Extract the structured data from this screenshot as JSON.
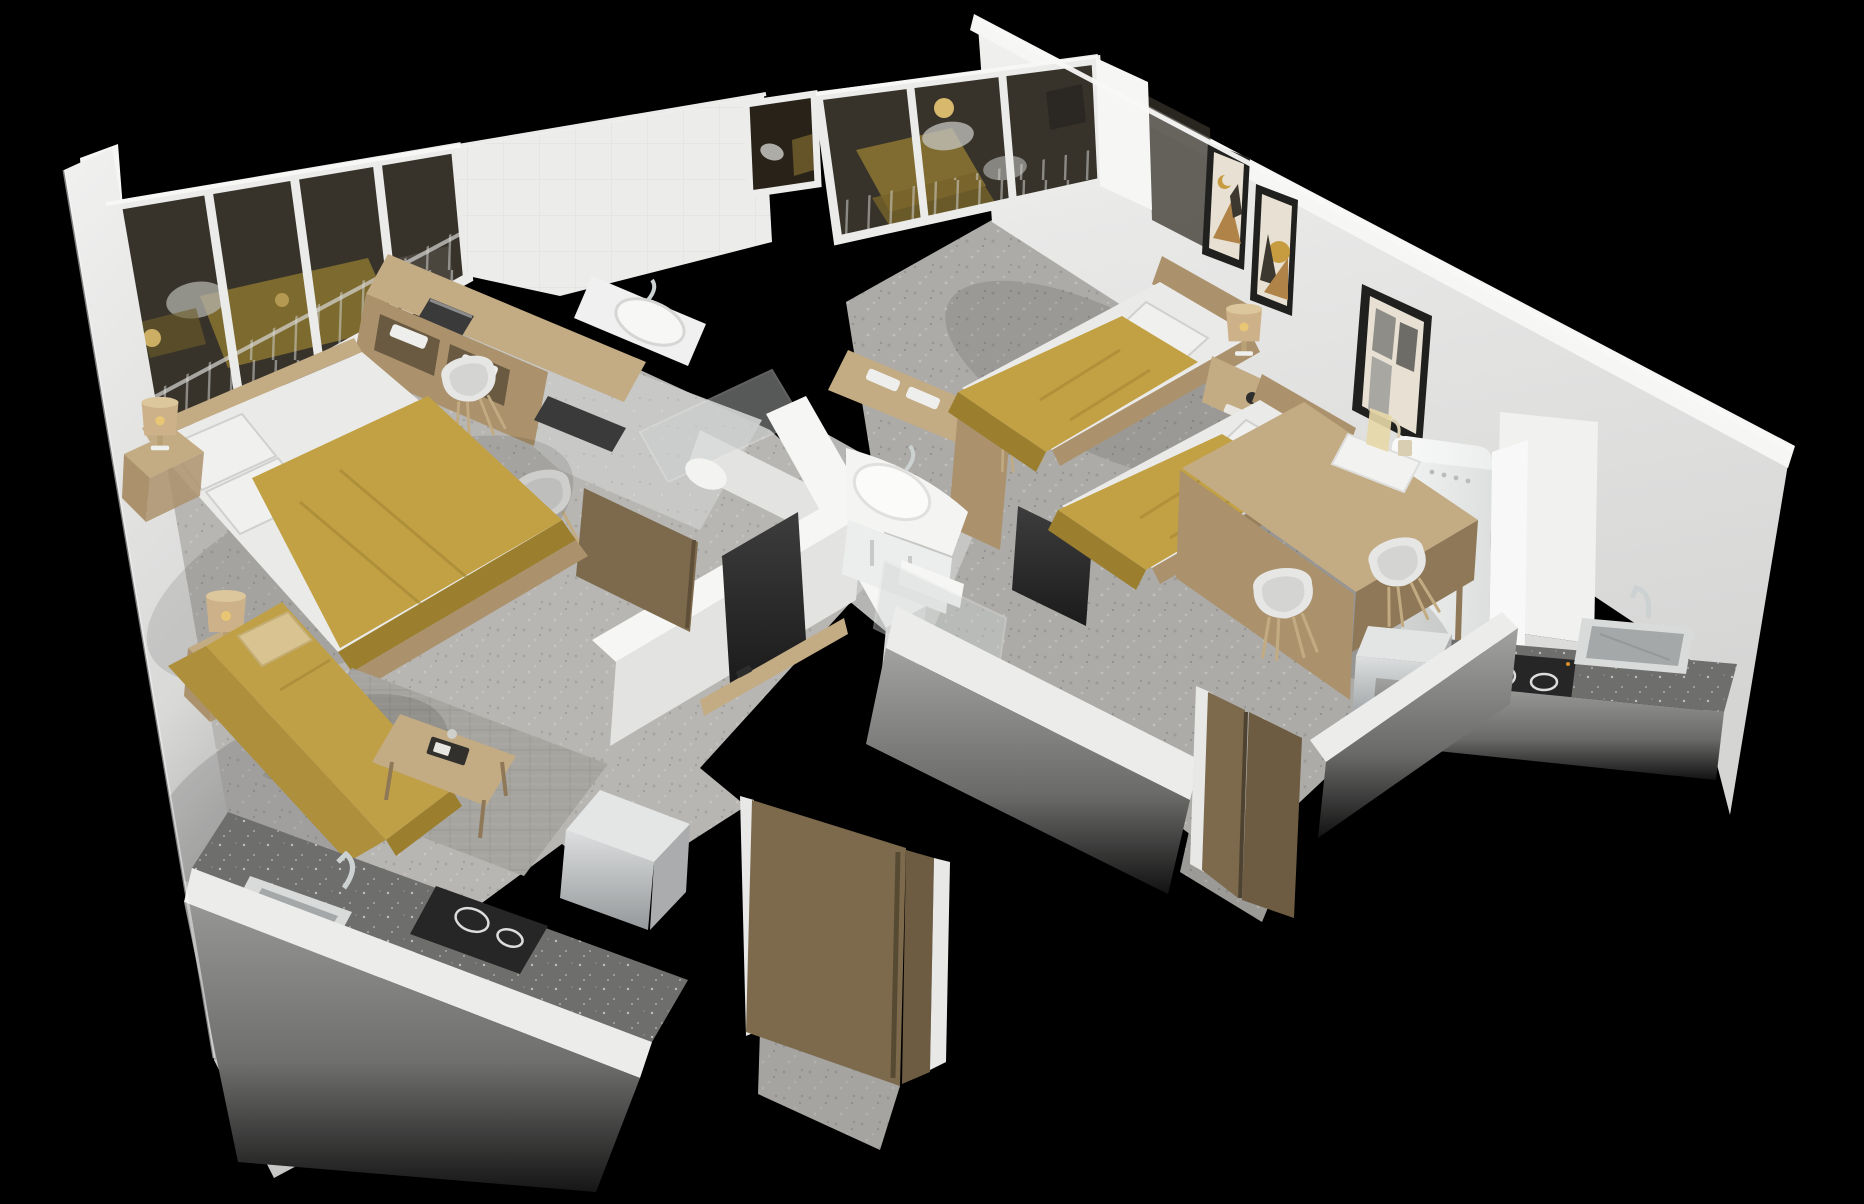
{
  "scene": {
    "type": "3d-apartment-floorplan-render",
    "view": "isometric-cutaway",
    "background": "#000000",
    "units": [
      {
        "id": "studio-left",
        "rooms": [
          "bedroom-living",
          "bathroom",
          "kitchenette",
          "entry-hall",
          "balcony"
        ],
        "furniture": [
          "double-bed",
          "nightstands-with-lamps",
          "yellow-sofa",
          "cream-throw-pillow",
          "coffee-table",
          "area-rug",
          "kitchen-counter",
          "steel-sink",
          "induction-cooktop",
          "mini-appliance-box",
          "wall-tv",
          "media-shelf",
          "desk-with-laptops",
          "towel-shelving",
          "vanity-sink",
          "shell-chairs",
          "entry-door",
          "bathroom-door",
          "glazed-balcony-wall",
          "balcony-railing"
        ]
      },
      {
        "id": "studio-right",
        "rooms": [
          "twin-bedroom",
          "bathroom",
          "kitchenette",
          "entry-hall",
          "balcony"
        ],
        "furniture": [
          "single-bed-1",
          "single-bed-2",
          "nightstand-with-lamp",
          "alarm-clock",
          "framed-wall-art-pair",
          "leaning-art-frame",
          "retro-fridge",
          "kitchen-counter",
          "steel-sink",
          "induction-cooktop",
          "mini-appliance-box",
          "dining-desk-table",
          "serving-tray-with-pitcher",
          "shell-chairs",
          "wall-tv",
          "curved-vanity-sink",
          "shower-glass-toilet",
          "desk-with-towels",
          "entry-door",
          "glazed-balcony-wall",
          "balcony-railing",
          "small-bathroom-window"
        ]
      }
    ]
  },
  "colors": {
    "background": "#000000",
    "wall_top": "#f6f6f5",
    "wall_face": "#ececeb",
    "wall_face_shade": "#d7d7d6",
    "wall_inner": "#e3e3e2",
    "wall_outer": "#9a9a99",
    "floor_light": "#b7b6b3",
    "floor_mid": "#adacaa",
    "floor_bath": "#cacac8",
    "rug": "#a7a5a0",
    "glass_dark": "#37332b",
    "mullion": "#ebebe9",
    "counter_dark": "#6e6e6c",
    "cooktop_black": "#262626",
    "steel_light": "#d9dbdb",
    "steel_dark": "#a4a8a9",
    "chrome": "#ccd1d2",
    "fridge_white": "#eff1f0",
    "tv_black": "#262626",
    "wood_light": "#c3ab84",
    "wood_mid": "#ab926c",
    "wood_dark": "#8f7857",
    "door_wood": "#7d6a4d",
    "bed_yellow": "#c2a144",
    "bed_yellow_dark": "#9b7f2f",
    "sofa_yellow": "#bfa047",
    "sofa_yellow_dark": "#ad8f3c",
    "pillow_cream": "#d9c491",
    "sheet_white": "#eaeae8",
    "pillow_white": "#f0f0ee",
    "lamp_beige": "#cdb289",
    "lamp_glow": "#e9c773",
    "chair_white": "#e6e6e4",
    "chair_leg": "#c2ab82",
    "frame_black": "#20201e",
    "art_paper": "#e8e1d3",
    "art_tan": "#b08449",
    "art_dark": "#3c372f",
    "art_mustard": "#c79c40"
  }
}
